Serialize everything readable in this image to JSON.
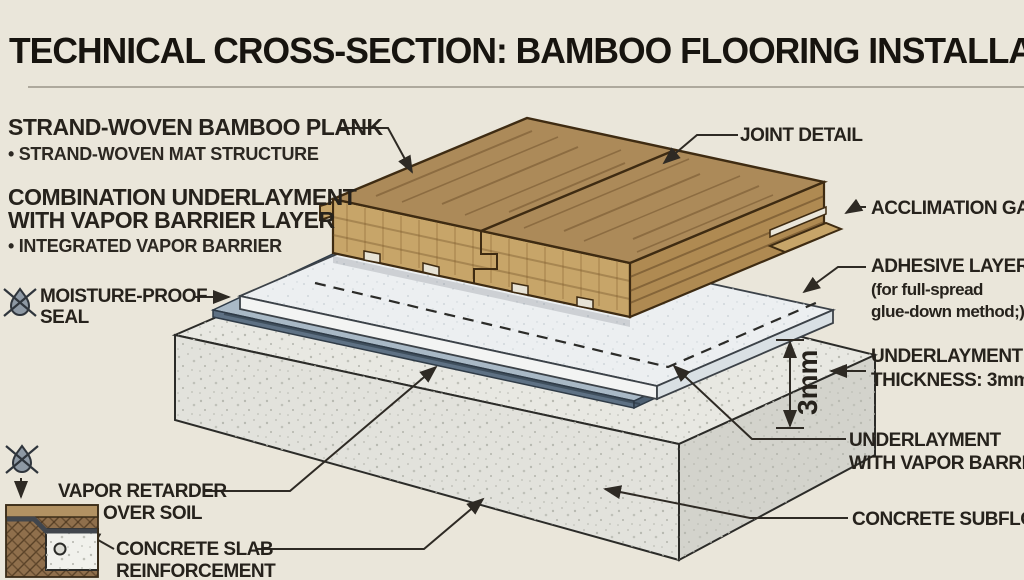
{
  "header": {
    "title": "TECHNICAL CROSS-SECTION: BAMBOO FLOORING INSTALLATION"
  },
  "labels_left": {
    "plank_heading": "STRAND-WOVEN BAMBOO PLANK",
    "plank_sub": "• STRAND-WOVEN MAT STRUCTURE",
    "underlayment_heading_line1": "COMBINATION UNDERLAYMENT",
    "underlayment_heading_line2": "WITH VAPOR BARRIER LAYER",
    "underlayment_sub": "• INTEGRATED VAPOR BARRIER",
    "moisture_seal_line1": "MOISTURE-PROOF",
    "moisture_seal_line2": "SEAL",
    "vapor_retarder_line1": "VAPOR RETARDER",
    "vapor_retarder_line2": "OVER SOIL",
    "slab_reinforcement_line1": "CONCRETE SLAB",
    "slab_reinforcement_line2": "REINFORCEMENT"
  },
  "labels_right": {
    "joint_detail": "JOINT DETAIL",
    "acclimation_gap": "ACCLIMATION GAP",
    "adhesive_line1": "ADHESIVE LAYER",
    "adhesive_line2": "(for full-spread",
    "adhesive_line3": "glue-down method;)",
    "thickness_line1": "UNDERLAYMENT",
    "thickness_line2": "THICKNESS: 3mm",
    "underlayment_vb_line1": "UNDERLAYMENT",
    "underlayment_vb_line2": "WITH VAPOR BARRIER",
    "concrete_subfloor": "CONCRETE SUBFLOOR"
  },
  "dimension": {
    "underlayment_thickness": "3mm"
  },
  "icons": {
    "no_moisture_top": "crossed-water-droplet",
    "no_moisture_bottom": "crossed-water-droplet"
  },
  "colors": {
    "background": "#EAE6DA",
    "line": "#2E2A24",
    "wood_top": "#AC8A59",
    "wood_face": "#C7A569",
    "wood_end": "#AF8A52",
    "underlayment_top": "#ECEFF1",
    "underlayment_front": "#F3F4F3",
    "underlayment_side": "#D9E0E4",
    "vapor_top": "#A9B9C6",
    "vapor_front": "#5E7184",
    "concrete_top": "#E8E8E2",
    "concrete_front": "#E2E2DC",
    "concrete_side": "#D3D3CC",
    "soil": "#8F6F4C",
    "soil_surface": "#B29263",
    "slab": "#F1F1EC"
  }
}
